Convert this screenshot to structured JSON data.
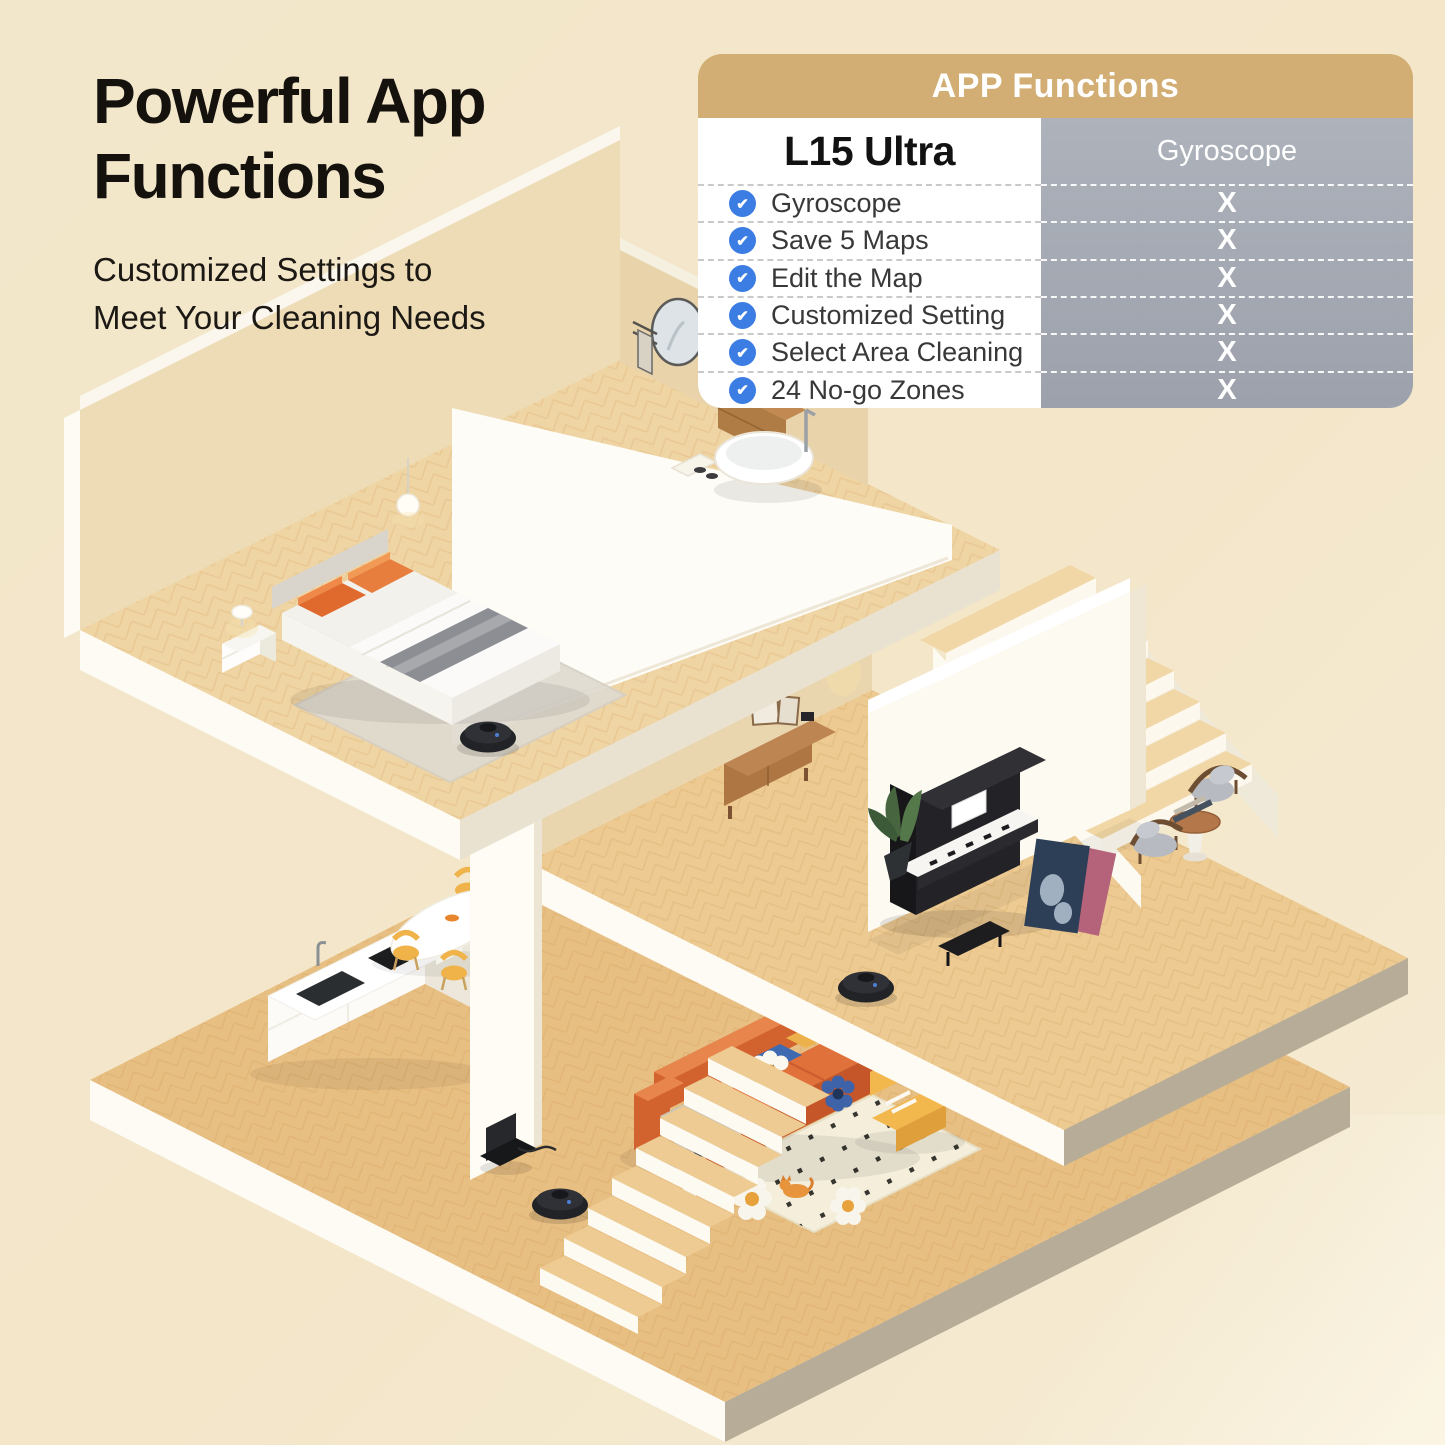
{
  "page": {
    "width": 1445,
    "height": 1445,
    "background_top": "#f3e7cb",
    "background_bottom": "#f6ecd5"
  },
  "headline": {
    "title_line1": "Powerful App",
    "title_line2": "Functions",
    "subtitle_line1": "Customized Settings to",
    "subtitle_line2": "Meet Your Cleaning Needs"
  },
  "comparison_table": {
    "header": "APP Functions",
    "columns": {
      "product": "L15 Ultra",
      "competitor": "Gyroscope"
    },
    "rows": [
      {
        "feature": "Gyroscope",
        "product": "✔",
        "competitor": "X"
      },
      {
        "feature": "Save 5 Maps",
        "product": "✔",
        "competitor": "X"
      },
      {
        "feature": "Edit the Map",
        "product": "✔",
        "competitor": "X"
      },
      {
        "feature": "Customized Setting",
        "product": "✔",
        "competitor": "X"
      },
      {
        "feature": "Select Area Cleaning",
        "product": "✔",
        "competitor": "X"
      },
      {
        "feature": "24 No-go Zones",
        "product": "✔",
        "competitor": "X"
      }
    ],
    "colors": {
      "header_bg": "#d3ae74",
      "header_text": "#ffffff",
      "product_col_bg": "#ffffff",
      "competitor_col_bg": "#a5aab3",
      "check_circle": "#3b7de2",
      "x_text": "#ffffff"
    }
  },
  "illustration": {
    "type": "isometric-cutaway-home",
    "colors": {
      "floor_wood": "#eccb92",
      "fascia_light": "#fdfbf4",
      "fascia_shadow": "#b6ac97",
      "wall_beige": "#ead6ae",
      "wall_white": "#fdfaf2",
      "sofa_orange": "#d2622e",
      "accent_yellow": "#efb34a",
      "robot_black": "#212327"
    },
    "robot_count": 3
  }
}
